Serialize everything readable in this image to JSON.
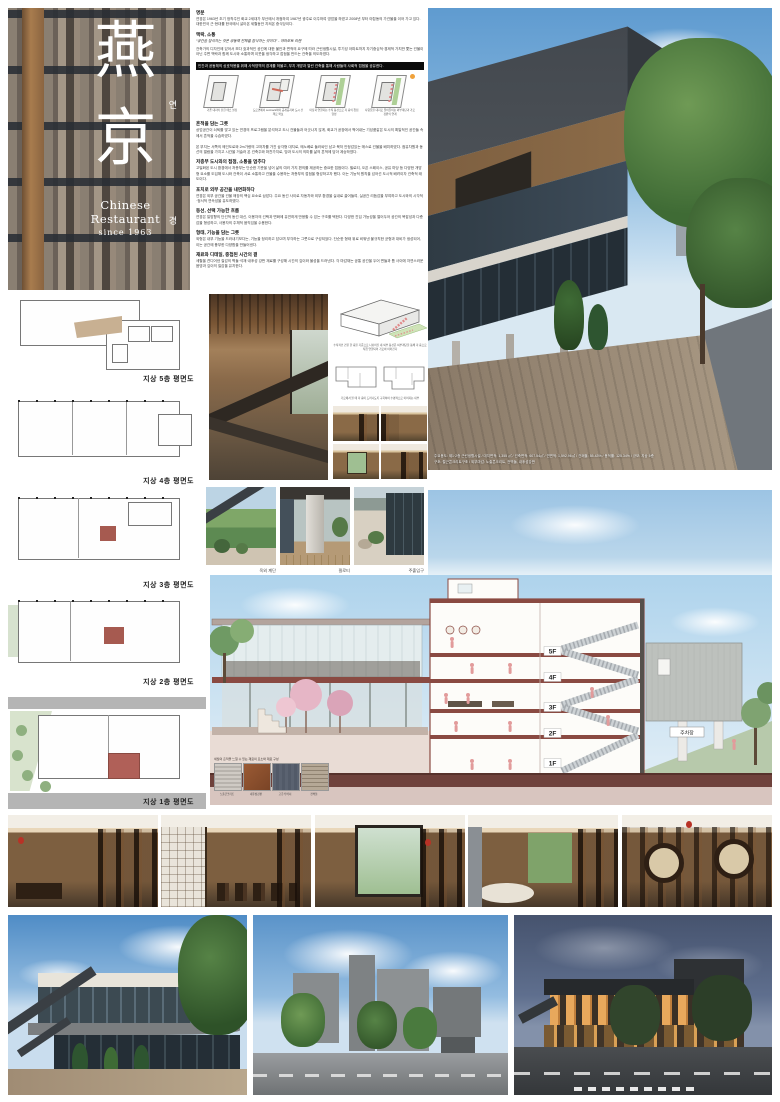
{
  "logo": {
    "hanja_top": "燕",
    "reading_top": "연",
    "hanja_bottom": "京",
    "reading_bottom": "경",
    "subtitle": "Chinese Restaurant",
    "since": "since 1963"
  },
  "intro": {
    "s1": {
      "heading": "명분",
      "body": "연경은 1963년 초기 정착주인 화교 2세대가 부산에서 개점하여 1987년 광주로 이주하여 영업을 하였고 2008년 부터 야탑동의 가건물을 이어 가고 있다. 대한민국 근·현대를 한국에서 살아온 세월동안 지켜온 중식당이다."
    },
    "s2": {
      "heading": "맥락, 소통",
      "quote": "“공간을 잠식하는 것은 공동체 전체를 잠식하는 것이다” - 야마모토 리켄",
      "body": "건축가의 디자인에 있어서 보다 효과적인 공간에 대한 불안과 면적의 요구에 따라 근린생활시설, 투기성 아파트까지 자기중심적·경제적 가치만 쫓는 건물이 아닌 주변 맥락과 함께 도시와 소통하며 이웃을 생각하고 접점을 만드는 건축을 의도하였다."
    },
    "highlight": "인간과 공동체의 상호작용을 위해 사적영역의 경계를 허물고, 부지 개방과 열린 건축을 통해 사람들의 사회적 접점을 공유한다.",
    "diagrams": [
      {
        "caption": "기존 대지의 닫힌 매스 설정"
      },
      {
        "caption": "도로면에서 set-back하여 공개공지와 도시 산책로 확보"
      },
      {
        "caption": "마당과 연결되는 수직 동선으로 각 층의 접점 형성"
      },
      {
        "caption": "사람들을 대지로 끌어들이는 외부계단과 가로 정원의 연계"
      }
    ],
    "s3": {
      "heading": "흔적을 담는 그릇",
      "body": "상업공간이 쇠퇴를 맞고 있는 연경의 프로그램을 분석하고 도시 건물들과 어긋나지 않게, 화교가 공장에서 찍어내는 기성품같은 도시의 획일적인 공간들 속에서 흔적을 수습하였다.\n\n본 부지는 서쪽의 메인도로와 2m가량의 고저차를 가진 삼각형 대지로, 메노베로 둘러싸인 남고·북저 안정감있는 매스로 건물을 배치하였다. 점유차원과 동선의 열람을 가지고 시간을 거슬러 온 건축주와 마찬가지로, 땅과 도시의 의미를 삶의 흔적에 담아 계승하였다."
    },
    "s4": {
      "heading": "저층부 도시와의 접점, 소통을 멈추다",
      "body": "고밀화된 도시 환경에서 저층부는 단순한 기준을 넘어 삶의 여러 가지 편의를 제공하는 중요한 접점이다. 필로티, 오픈 스페이스, 공유 마당 등 다양한 개방형 요소를 도입해 도시와 건축이 서로 소통하고 건물을 수용하는 저층부의 접점을 형성하고자 했다. 이는 기능적 원칙을 넘어선 도시적 배려이자 건축적 태도이다."
    },
    "s5": {
      "heading": "포치로 외부 공간을 내면화하다",
      "body": "연경은 외부 공간을 건물 매장의 핵심 요소로 삼았다. 주요 동선 사이로 자동차와 외부 환경을 실내로 끌어들여, 실공간 리듬감을 부여하고 도시와의 시각적·정서적 연속성을 유도하였다."
    },
    "s6": {
      "heading": "동선, 선택 가능한 흐름",
      "body": "연경은 일방향의 단선적 동선 대신, 이용자의 선택과 변화에 유연하게 반응할 수 있는 구조를 택한다. 다양한 진입 가능성을 열어두어 공간의 복잡성과 다층감을 형성하고, 사용자의 주체적 움직임을 수용한다."
    },
    "s7": {
      "heading": "형태, 기능을 담는 그릇",
      "body": "외형은 내부 기능을 드러내기보다는, 기능을 정리하고 담으며 부각하는 그릇으로 구성되었다. 단순한 형태 위로 비워낸 불규칙한 균형과 대비가 생성되어, 이는 공간에 풍부한 다양함을 만들어낸다."
    },
    "s8": {
      "heading": "재료와 디테일, 중첩된 시간의 결",
      "body": "세월을 견디어낸 질감의 벽돌·석재·내후성 강판 재료를 구성해 시간의 깊이와 물성을 드러낸다. 각 마감재는 공통 공간을 두어 면들과 틈 사이에 자연스러운 음영과 깊이의 질감을 유지한다."
    }
  },
  "hero": {
    "caption_line1": "주요용도: 제1·2종 근린생활시설 / 대지면적: 1,355 ㎡ / 건축면적: 607.54㎡ / 연면적: 1,592.96㎡ / 건폐율: 55.43% / 용적률: 125.34% / 규모: 지상 5층",
    "caption_line2": "구조: 철근콘크리트구조 / 외부마감: 노출콘크리트, 전벽돌, 내후성강판"
  },
  "plans": {
    "labels": [
      "지상 5층 평면도",
      "지상 4층 평면도",
      "지상 3층 평면도",
      "지상 2층 평면도",
      "지상 1층 평면도"
    ]
  },
  "middle": {
    "axon_caption": "수직적인 건물 한 층을 기준으로 나뉘어진 내·외부 동선은 외부계단을 통해 각 층으로 직접 연결되어 가로와 이어진다",
    "miniplan_caption": "가로에서 볼 때 각 층이 드러나도록 구획하여 수평적으로 이어지는 내부"
  },
  "site_photos": {
    "captions": [
      "옥외 계단",
      "필로티",
      "주출입구"
    ]
  },
  "section": {
    "floors": [
      "5F",
      "4F",
      "3F",
      "2F",
      "1F"
    ],
    "annex_label": "주차장",
    "materials_caption": "세월의 흔적을 느낄 수 있는 재료의 요소와 재료 구성",
    "materials": [
      "노출콘크리트",
      "내후성강판",
      "고흥석 버너",
      "전벽돌"
    ]
  },
  "colors": {
    "slab_red": "#8a4a42",
    "sky_blue": "#aed3ec",
    "highlight_black": "#0a0a0a"
  }
}
